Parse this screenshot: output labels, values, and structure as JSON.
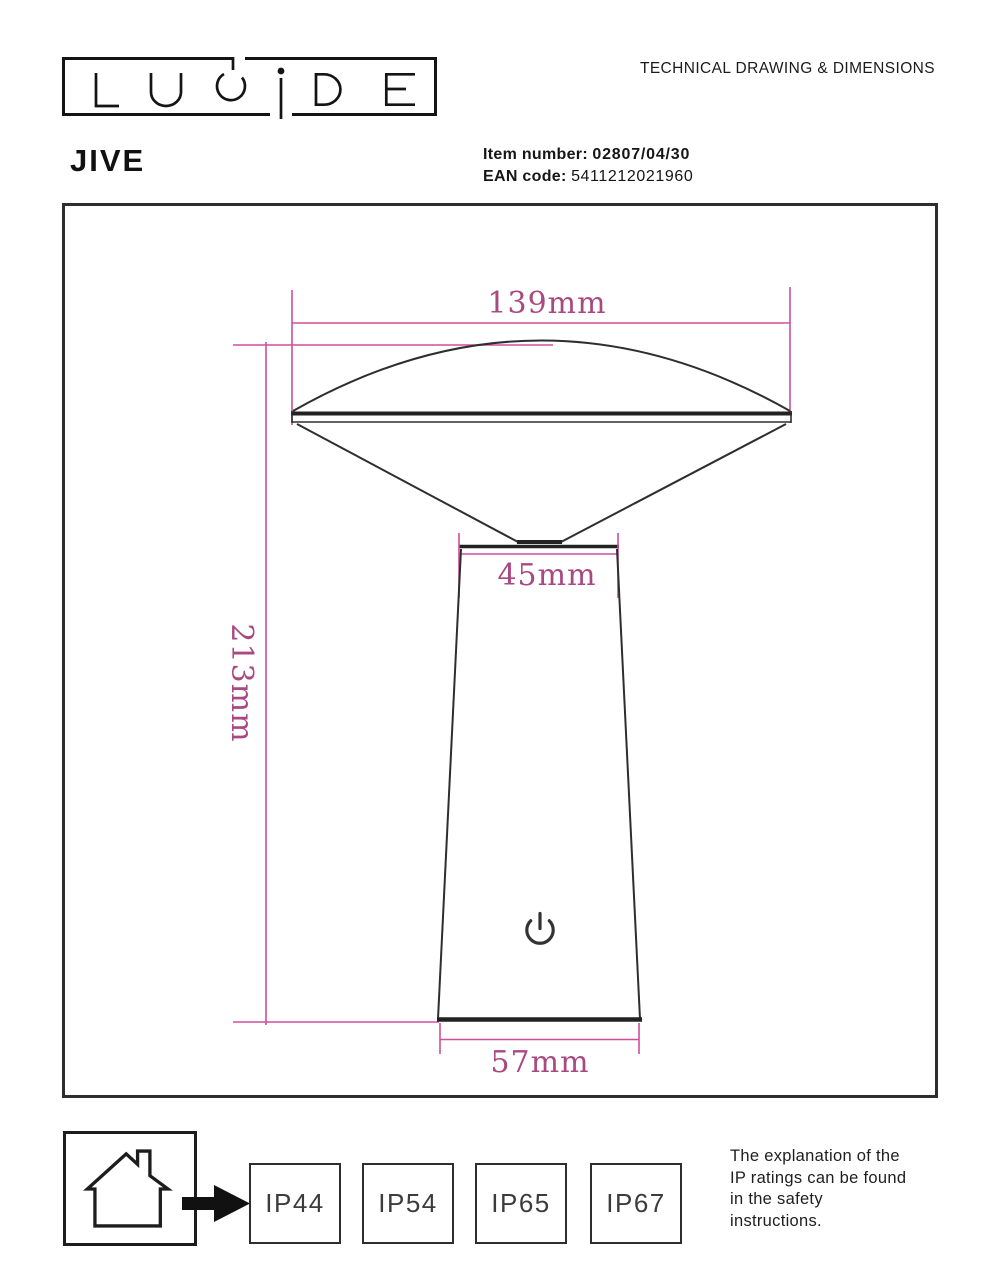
{
  "header": {
    "brand": "LUCIDE",
    "logo_letters": [
      "L",
      "U",
      "C",
      "i",
      "D",
      "E"
    ],
    "product_name": "JIVE",
    "doc_title": "TECHNICAL DRAWING & DIMENSIONS",
    "item_number_label": "Item number:",
    "item_number_value": "02807/04/30",
    "ean_label": "EAN code:",
    "ean_value": "5411212021960"
  },
  "drawing": {
    "dimensions": {
      "shade_width": "139mm",
      "neck_width": "45mm",
      "total_height": "213mm",
      "base_width": "57mm"
    },
    "icons": [
      "power-symbol"
    ],
    "accent_line_color": "#cf4f9b",
    "accent_text_color": "#a84a81",
    "stroke_color": "#2e2e2e"
  },
  "footer": {
    "usage_icon": "indoor-house",
    "ip_ratings": [
      "IP44",
      "IP54",
      "IP65",
      "IP67"
    ],
    "note_lines": [
      "The explanation of the",
      "IP ratings can be found",
      "in the safety",
      "instructions."
    ]
  }
}
